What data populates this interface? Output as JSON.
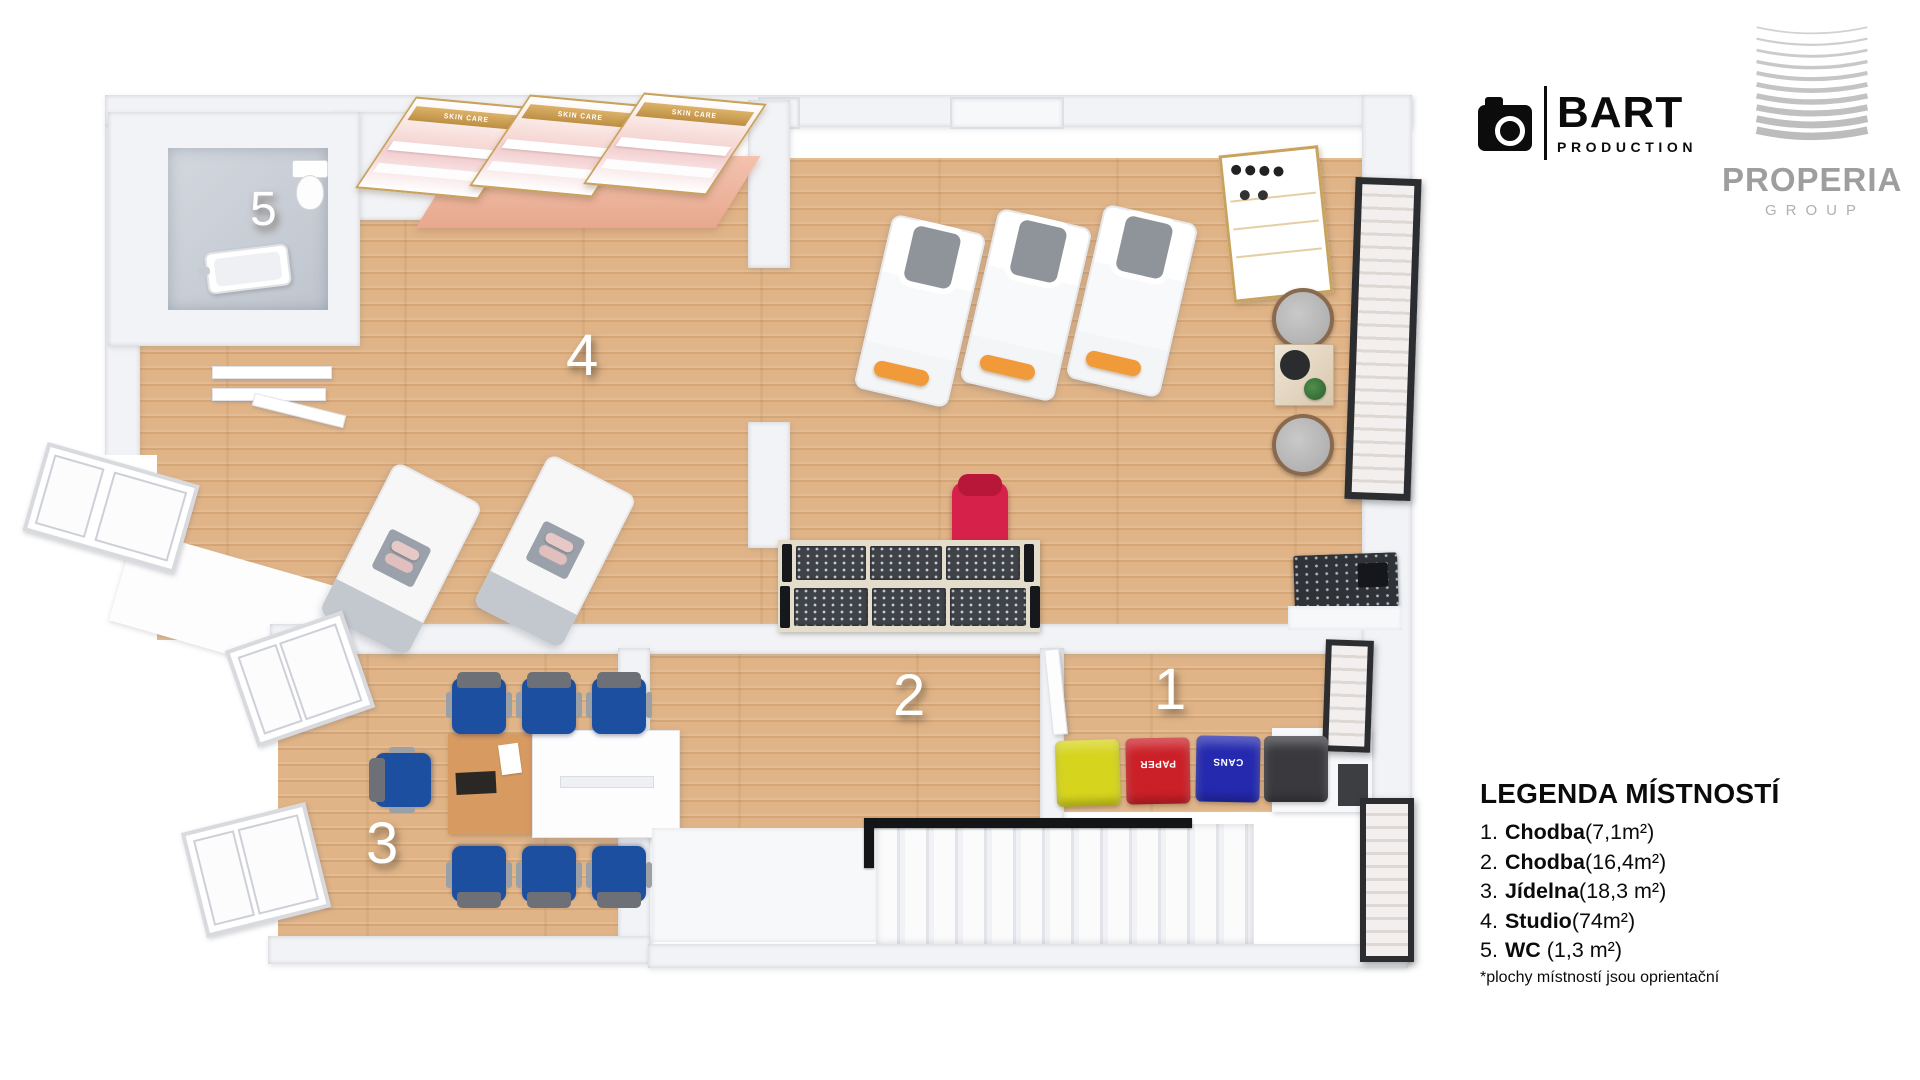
{
  "branding": {
    "bart": {
      "name": "BART",
      "sub": "PRODUCTION"
    },
    "properia": {
      "name": "PROPERIA",
      "sub": "GROUP"
    }
  },
  "legend": {
    "title": "LEGENDA MÍSTNOSTÍ",
    "items": [
      {
        "num": "1.",
        "name": "Chodba",
        "area": "(7,1m²)"
      },
      {
        "num": "2.",
        "name": "Chodba",
        "area": "(16,4m²)"
      },
      {
        "num": "3.",
        "name": "Jídelna",
        "area": "(18,3 m²)"
      },
      {
        "num": "4.",
        "name": "Studio",
        "area": "(74m²)"
      },
      {
        "num": "5.",
        "name": "WC",
        "area": " (1,3 m²)"
      }
    ],
    "footnote": "*plochy místností jsou oprientační"
  },
  "floorplan": {
    "room_numbers": {
      "r1": "1",
      "r2": "2",
      "r3": "3",
      "r4": "4",
      "r5": "5"
    },
    "labels": {
      "skin_care": "SKIN CARE",
      "paper": "PAPER",
      "cans": "CANS"
    },
    "colors": {
      "wood": "#e0b487",
      "wall": "#f2f3f6",
      "gold": "#c9a35e",
      "orange": "#f09a3a",
      "headgray": "#8f939a",
      "blue": "#1d4fa1",
      "red": "#d6224a",
      "binyellow": "#d6d41c",
      "binred": "#cb2027",
      "binblue": "#2429ae",
      "bindark": "#3a3a3e",
      "console": "#3f4347",
      "rail": "#141517",
      "bedfoot": "#c3c8cf"
    }
  }
}
